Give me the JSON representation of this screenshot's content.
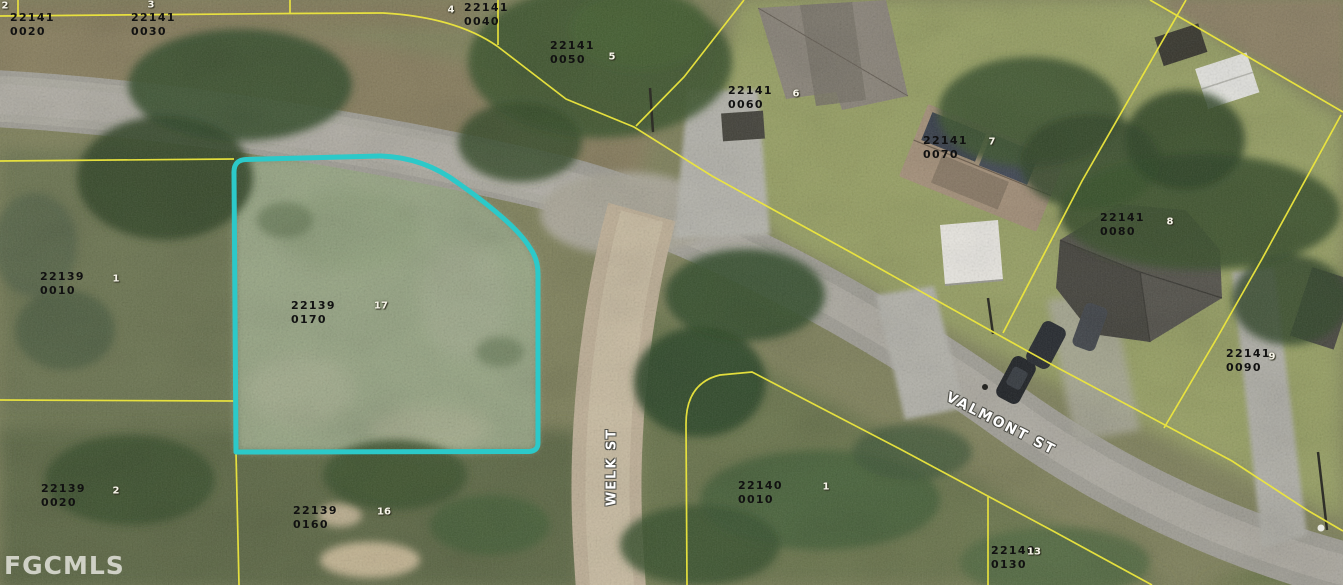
{
  "map": {
    "watermark": "FGCMLS",
    "streets": {
      "welk": "WELK ST",
      "valmont": "VALMONT ST"
    },
    "highlighted_parcel": {
      "id": "22139 0170",
      "outline_color": "#2cc9c9"
    },
    "colors": {
      "parcel_line": "#ece63e",
      "highlight": "#2cc9c9",
      "parcel_label_text": "#111111",
      "street_label_text": "#ffffff"
    },
    "parcel_labels": [
      {
        "id": "22141\n0020"
      },
      {
        "id": "22141\n0030"
      },
      {
        "id": "22141\n0040"
      },
      {
        "id": "22141\n0050"
      },
      {
        "id": "22141\n0060"
      },
      {
        "id": "22141\n0070"
      },
      {
        "id": "22141\n0080"
      },
      {
        "id": "22141\n0090"
      },
      {
        "id": "22139\n0010"
      },
      {
        "id": "22139\n0170"
      },
      {
        "id": "22139\n0020"
      },
      {
        "id": "22139\n0160"
      },
      {
        "id": "22140\n0010"
      },
      {
        "id": "22140\n0130"
      }
    ],
    "lot_markers": [
      "2",
      "3",
      "4",
      "5",
      "6",
      "7",
      "8",
      "9",
      "1",
      "17",
      "2",
      "16",
      "1",
      "13"
    ]
  }
}
